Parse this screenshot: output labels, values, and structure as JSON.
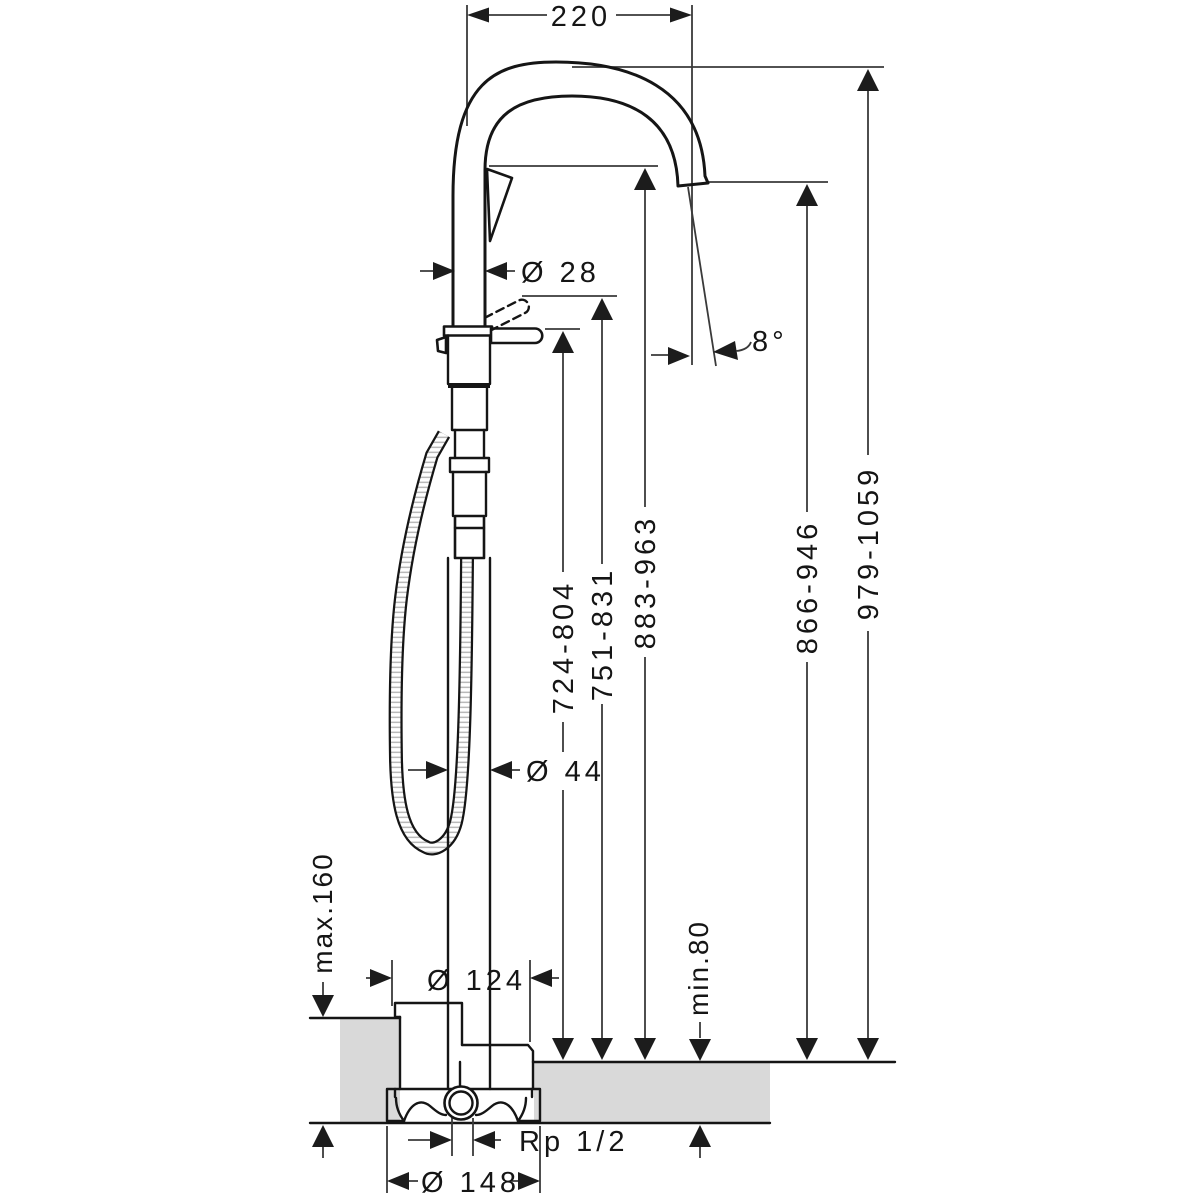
{
  "diagram": {
    "title": "Freestanding bath mixer - dimensional drawing",
    "units": "mm",
    "colors": {
      "line": "#151515",
      "floor_fill": "#d9d9d9",
      "background": "#ffffff"
    },
    "dimensions": {
      "spout_reach": "220",
      "spout_pipe_diameter": "Ø 28",
      "spray_angle": "8°",
      "height_handle_lowered": "724-804",
      "height_handle_raised": "751-831",
      "height_spout_underside": "883-963",
      "height_outlet": "866-946",
      "height_overall": "979-1059",
      "riser_diameter": "Ø 44",
      "floor_buildup_max": "max.160",
      "escutcheon_diameter": "Ø 124",
      "floor_buildup_min": "min.80",
      "connection_thread": "Rp 1/2",
      "basic_set_diameter": "Ø 148"
    }
  }
}
